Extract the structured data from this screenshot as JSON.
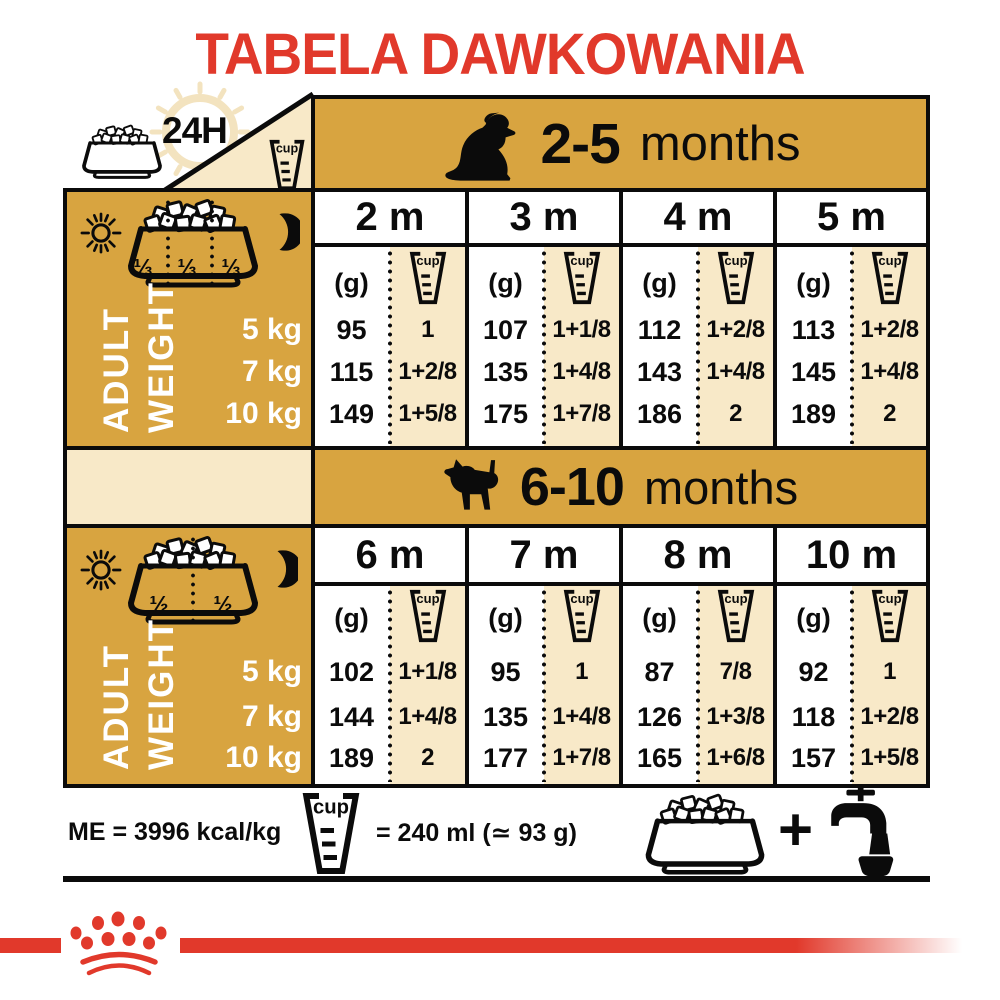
{
  "title": "TABELA DAWKOWANIA",
  "colors": {
    "gold": "#D8A440",
    "beige": "#F8E9C8",
    "red": "#E1392B",
    "ink": "#0B0B0B",
    "clock": "#F3E3BF"
  },
  "labels": {
    "h24": "24H",
    "cup": "cup",
    "adult": "ADULT",
    "weight": "WEIGHT"
  },
  "icons": {
    "bowl": "food-bowl-icon",
    "cup": "measuring-cup-icon",
    "clock": "clock-24h-icon",
    "sun": "sun-icon",
    "moon": "moon-icon",
    "dog_young": "sitting-puppy-icon",
    "dog_older": "standing-puppy-icon",
    "tap": "water-tap-icon",
    "crown": "royal-canin-crown-icon"
  },
  "tables": [
    {
      "age": "2-5",
      "months_word": "months",
      "portions": [
        "⅓",
        "⅓",
        "⅓"
      ],
      "weights": [
        "5 kg",
        "7 kg",
        "10 kg"
      ],
      "columns": [
        {
          "label": "2 m",
          "g_unit": "(g)",
          "g": [
            "95",
            "115",
            "149"
          ],
          "cups": [
            "1",
            "1+2/8",
            "1+5/8"
          ]
        },
        {
          "label": "3 m",
          "g_unit": "(g)",
          "g": [
            "107",
            "135",
            "175"
          ],
          "cups": [
            "1+1/8",
            "1+4/8",
            "1+7/8"
          ]
        },
        {
          "label": "4 m",
          "g_unit": "(g)",
          "g": [
            "112",
            "143",
            "186"
          ],
          "cups": [
            "1+2/8",
            "1+4/8",
            "2"
          ]
        },
        {
          "label": "5 m",
          "g_unit": "(g)",
          "g": [
            "113",
            "145",
            "189"
          ],
          "cups": [
            "1+2/8",
            "1+4/8",
            "2"
          ]
        }
      ]
    },
    {
      "age": "6-10",
      "months_word": "months",
      "portions": [
        "½",
        "½"
      ],
      "weights": [
        "5 kg",
        "7 kg",
        "10 kg"
      ],
      "columns": [
        {
          "label": "6 m",
          "g_unit": "(g)",
          "g": [
            "102",
            "144",
            "189"
          ],
          "cups": [
            "1+1/8",
            "1+4/8",
            "2"
          ]
        },
        {
          "label": "7 m",
          "g_unit": "(g)",
          "g": [
            "95",
            "135",
            "177"
          ],
          "cups": [
            "1",
            "1+4/8",
            "1+7/8"
          ]
        },
        {
          "label": "8 m",
          "g_unit": "(g)",
          "g": [
            "87",
            "126",
            "165"
          ],
          "cups": [
            "7/8",
            "1+3/8",
            "1+6/8"
          ]
        },
        {
          "label": "10 m",
          "g_unit": "(g)",
          "g": [
            "92",
            "118",
            "157"
          ],
          "cups": [
            "1",
            "1+2/8",
            "1+5/8"
          ]
        }
      ]
    }
  ],
  "footer": {
    "me": "ME = 3996 kcal/kg",
    "equiv": "= 240 ml (≃ 93 g)",
    "plus": "+"
  }
}
